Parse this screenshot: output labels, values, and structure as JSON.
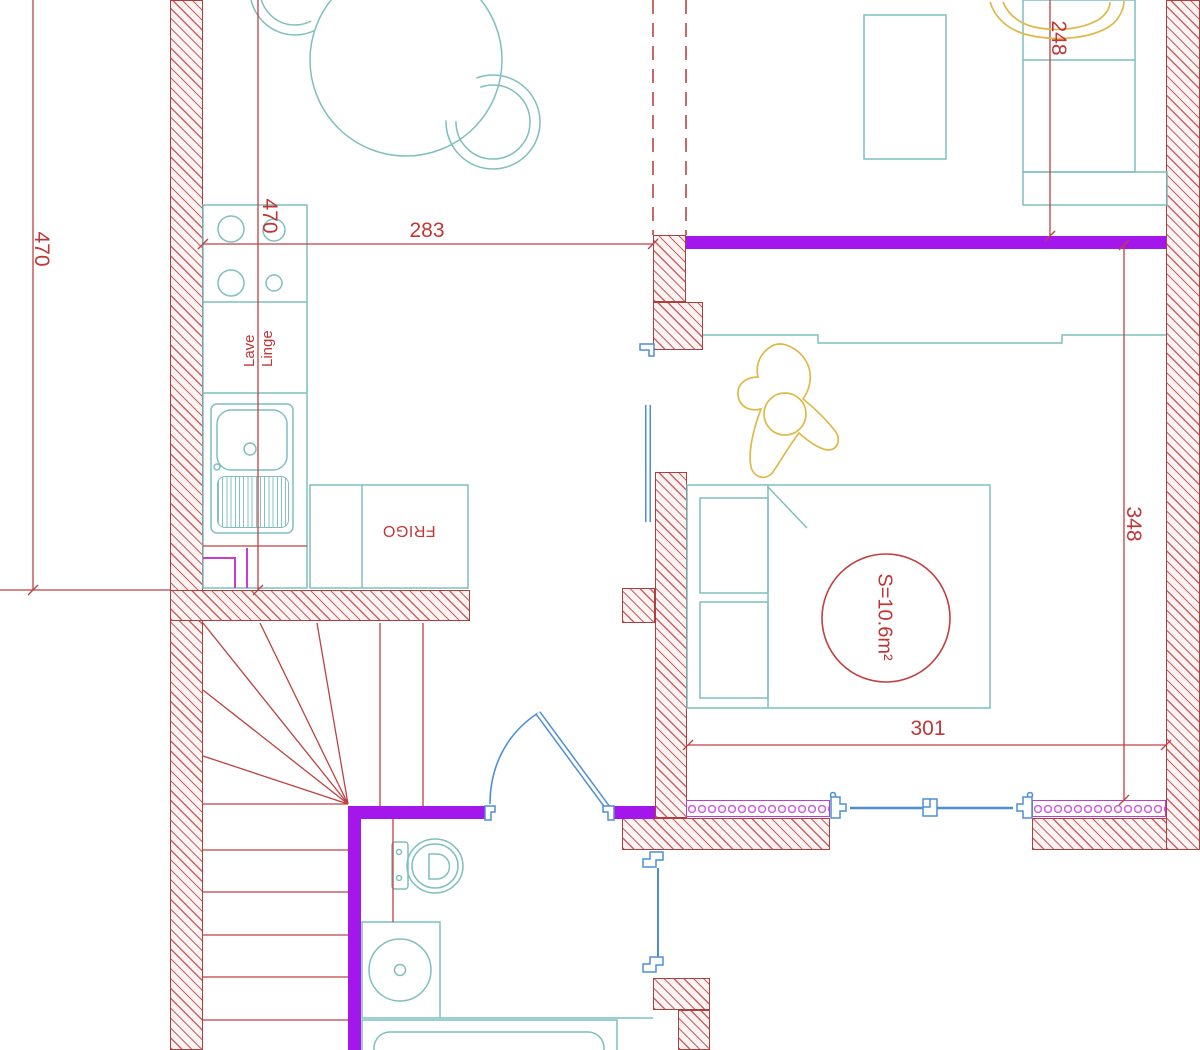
{
  "title": "apartment-floor-plan",
  "dimensions": {
    "left_wall": "470",
    "kitchen_run": "470",
    "hall_width": "283",
    "living_width": "248",
    "bedroom_depth": "348",
    "bedroom_width": "301"
  },
  "rooms": {
    "bedroom_area_label": "S=10.6m²"
  },
  "appliances": {
    "washing_machine": "Lave Linge",
    "fridge": "FRIGO"
  },
  "colors": {
    "wall_hatch_red": "#b23d3d",
    "partition_purple": "#a316ec",
    "fixture_teal": "#7fbfbf",
    "opening_blue": "#4d8fd6",
    "dimension_red": "#c13636",
    "mosaic_magenta": "#bb3fcc",
    "furniture_yellow": "#e0b84a"
  }
}
